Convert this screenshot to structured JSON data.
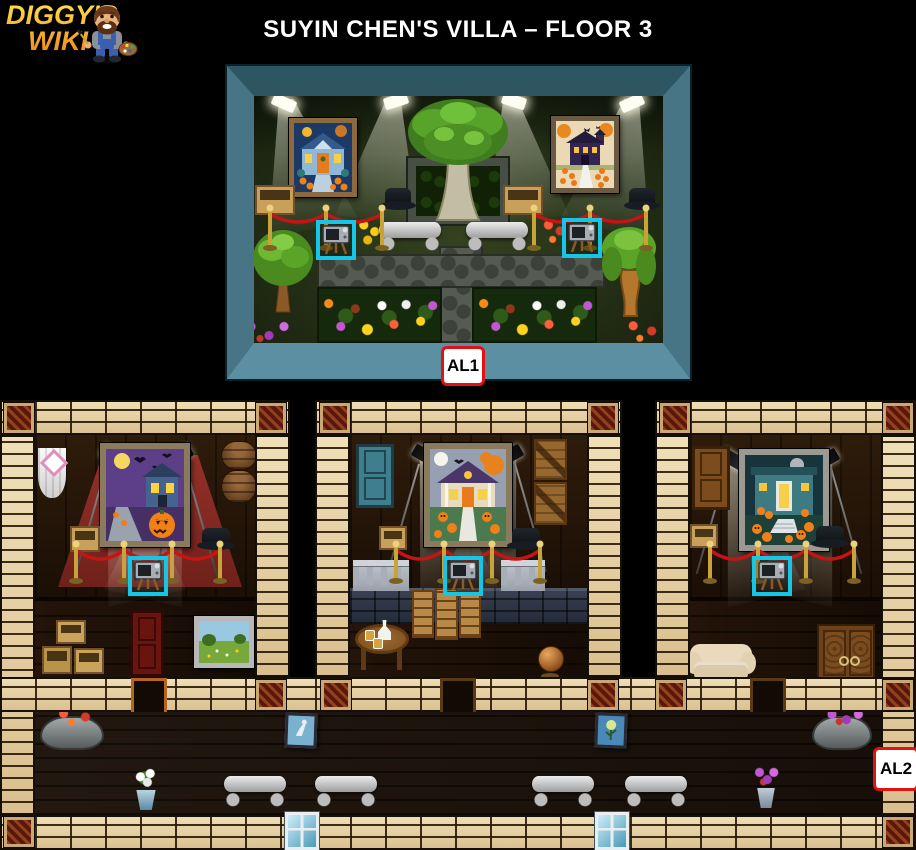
{
  "page": {
    "width": 916,
    "height": 850,
    "background": "#000000"
  },
  "logo": {
    "line1": "DIGGY'S",
    "line2": "WIKI",
    "character": "diggy-painter-avatar",
    "text_gradient_top": "#ffe049",
    "text_gradient_bottom": "#f08a1d"
  },
  "header": {
    "title": "SUYIN CHEN'S VILLA – FLOOR 3",
    "color": "#ffffff"
  },
  "markers": {
    "al1": {
      "label": "AL1"
    },
    "al2": {
      "label": "AL2"
    },
    "box_bg": "#ffffff",
    "box_border": "#e01212",
    "text_color": "#000000"
  },
  "palette": {
    "brick": "#e7d3a8",
    "mortar": "#2a1a0a",
    "ornate_tile": "#58190c",
    "diorama_frame": "#477586",
    "garden_grass": "#2b3a1c",
    "room_wood": "#221306",
    "highlight_cyan": "#16c6e6",
    "rope_red": "#c41414",
    "post_gold": "#c9a23a",
    "carpet_red": "#8c2a20"
  },
  "scene": {
    "upper_room": {
      "name": "rooftop-garden-diorama",
      "marker": "AL1",
      "paintings": [
        "halloween-blue-house-painting",
        "halloween-haunted-manor-painting"
      ],
      "items": [
        "spotlights",
        "velvet-rope-barrier",
        "tv-easel-highlight-left",
        "tv-easel-highlight-right",
        "stone-bench",
        "stone-bench",
        "central-tree-in-planter",
        "flower-bed-left",
        "flower-bed-right",
        "round-tree",
        "willow-tree",
        "cardboard-boxes",
        "black-pots",
        "stone-path-cross"
      ]
    },
    "lower_rooms": [
      {
        "name": "left-gallery",
        "painting": "halloween-purple-night-painting",
        "items": [
          "red-carpet",
          "spotlights",
          "velvet-rope-barrier",
          "tv-easel-highlight",
          "white-curtain",
          "pink-diamond-shield",
          "barrels",
          "cardboard-box",
          "top-hat",
          "gold-crate-stack",
          "red-door",
          "landscape-painting-on-easel"
        ]
      },
      {
        "name": "middle-gallery",
        "painting": "halloween-porch-house-painting",
        "items": [
          "spotlights",
          "velvet-rope-barrier",
          "tv-easel-highlight",
          "teal-door",
          "wooden-crates",
          "stone-balustrade",
          "wooden-fence-panels",
          "drinks-table",
          "copper-globe",
          "cardboard-box",
          "top-hat"
        ]
      },
      {
        "name": "right-gallery",
        "painting": "halloween-teal-house-painting",
        "items": [
          "spotlights",
          "velvet-rope-barrier",
          "tv-easel-highlight",
          "brown-door",
          "cream-sofa",
          "wooden-cabinet",
          "cardboard-box",
          "top-hat"
        ]
      }
    ],
    "corridor": {
      "marker": "AL2",
      "items": [
        "stone-planter-red-flowers",
        "leaning-artwork",
        "white-flower-pot",
        "stone-bench",
        "stone-bench",
        "leaning-artwork",
        "stone-bench",
        "stone-bench",
        "pink-flower-pot",
        "stone-planter-purple-flowers",
        "window",
        "window"
      ]
    }
  }
}
